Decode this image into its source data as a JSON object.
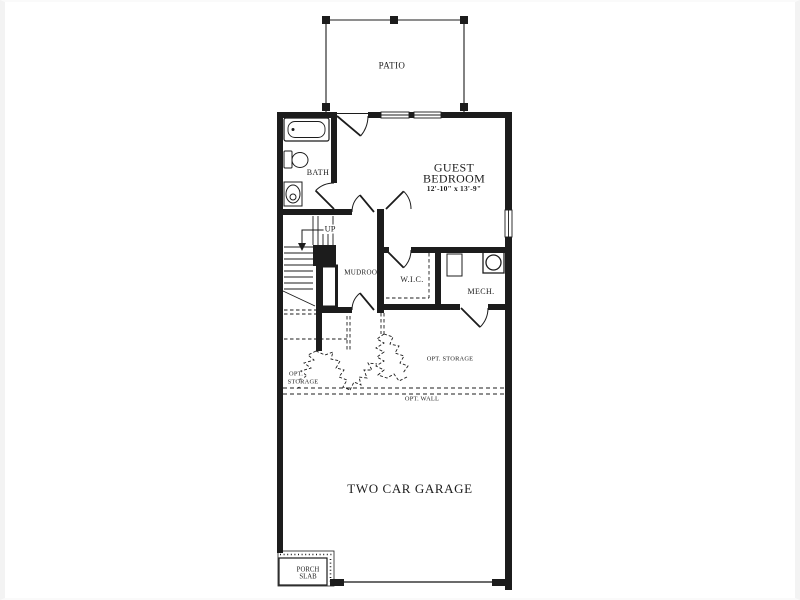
{
  "floor_plan": {
    "background": "#ffffff",
    "line_color": "#1c1c1c",
    "frame_color": "#f3f3f3",
    "labels": {
      "patio": "PATIO",
      "guest_bedroom_1": "GUEST",
      "guest_bedroom_2": "BEDROOM",
      "guest_bedroom_dims": "12'-10\" x 13'-9\"",
      "bath": "BATH",
      "stairs_up": "UP",
      "mudroom": "MUDROOM",
      "walk_in_closet": "W.I.C.",
      "mechanical": "MECH.",
      "opt_storage_left_1": "OPT.",
      "opt_storage_left_2": "STORAGE",
      "opt_storage_right": "OPT. STORAGE",
      "opt_wall": "OPT. WALL",
      "garage": "TWO CAR GARAGE",
      "porch_1": "PORCH",
      "porch_2": "SLAB"
    }
  }
}
